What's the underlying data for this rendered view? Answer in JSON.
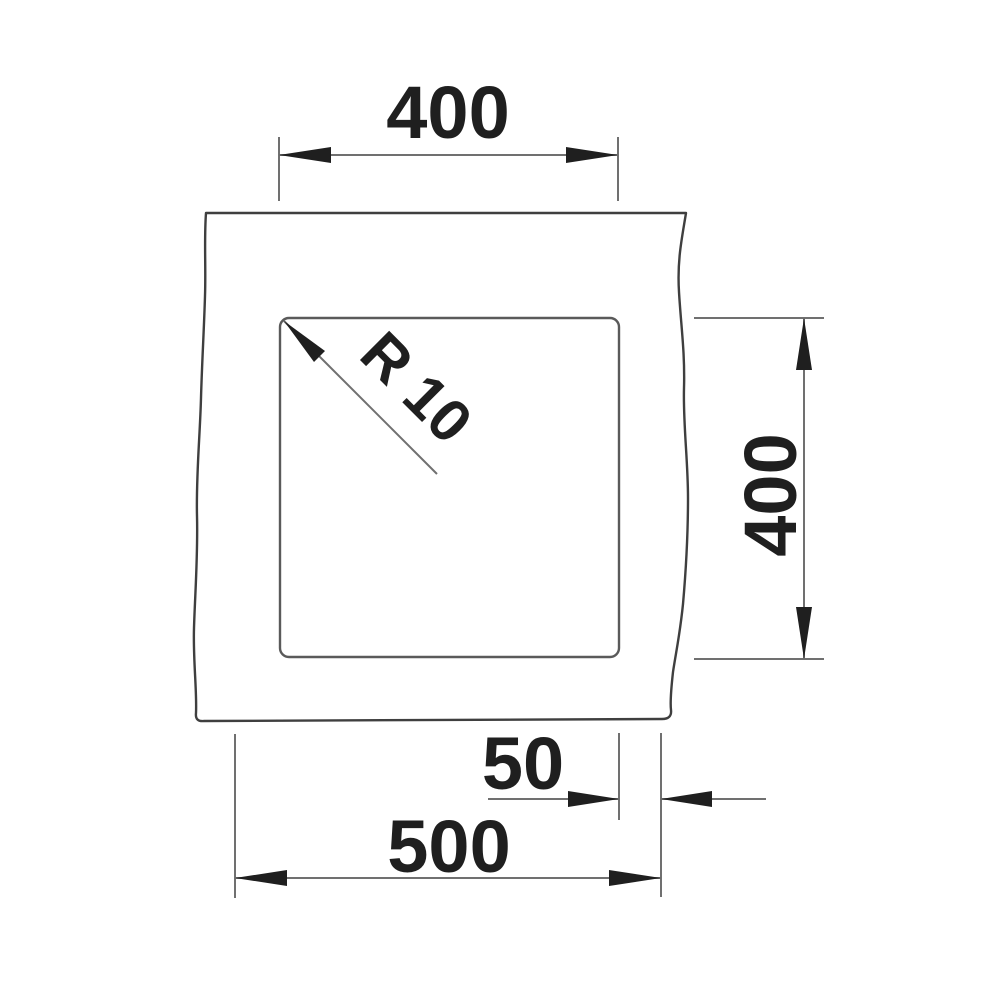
{
  "drawing": {
    "dimensions": {
      "top_width": "400",
      "right_height": "400",
      "corner_radius": "R 10",
      "right_edge_offset": "50",
      "overall_width": "500"
    },
    "colors": {
      "background": "#ffffff",
      "outline": "#3f3f3f",
      "cutout_line": "#5a5a5a",
      "dimension_line": "#707070",
      "arrow": "#1f1f1f",
      "text": "#1f1f1f"
    }
  }
}
